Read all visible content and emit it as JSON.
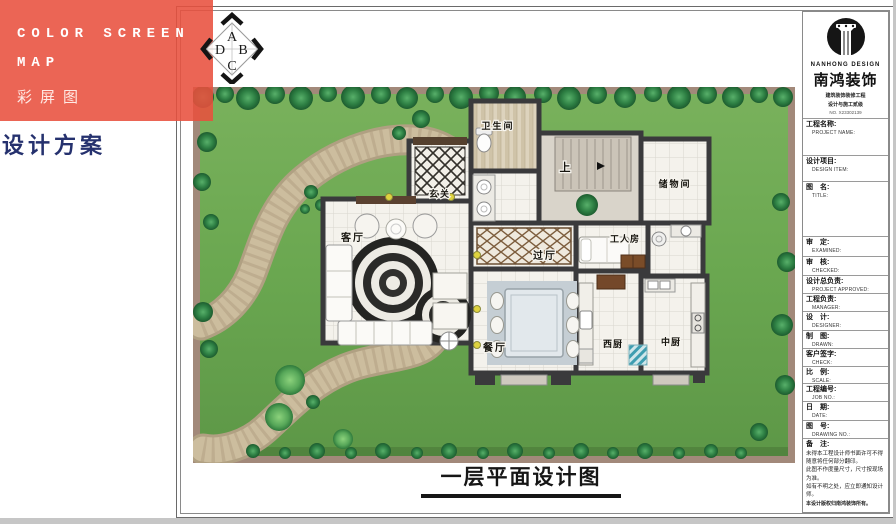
{
  "banner": {
    "title_line1": "COLOR SCREEN",
    "title_line2": "MAP",
    "title_line3": "彩屏图",
    "background_color": "#E8503E"
  },
  "page": {
    "scheme_label": "设计方案",
    "drawing_title": "一层平面设计图"
  },
  "compass": {
    "top": "A",
    "right": "B",
    "bottom": "C",
    "left": "D"
  },
  "plan": {
    "colors": {
      "lawn": "#6BA750",
      "lawn_border": "#A2897A",
      "wall": "#3A3A3C",
      "path": "#CCBD9E"
    },
    "rooms": [
      {
        "id": "bathroom",
        "label": "卫生间"
      },
      {
        "id": "entry",
        "label": "玄关"
      },
      {
        "id": "stairs-up",
        "label": "上"
      },
      {
        "id": "storage",
        "label": "储物间"
      },
      {
        "id": "living-room",
        "label": "客厅"
      },
      {
        "id": "hallway",
        "label": "过厅"
      },
      {
        "id": "worker-room",
        "label": "工人房"
      },
      {
        "id": "dining-room",
        "label": "餐厅"
      },
      {
        "id": "west-kitchen",
        "label": "西厨"
      },
      {
        "id": "chinese-kitchen",
        "label": "中厨"
      }
    ]
  },
  "titleblock": {
    "logo": {
      "name_en": "NANHONG DESIGN",
      "name_zh": "南鸿装饰",
      "sub1": "建筑装饰装修工程",
      "sub2": "设计与施工贰级",
      "license": "NO. X23302139"
    },
    "fields": [
      {
        "zh": "工程名称:",
        "en": "PROJECT NAME:"
      },
      {
        "zh": "设计项目:",
        "en": "DESIGN ITEM:"
      },
      {
        "zh": "图　名:",
        "en": "TITLE:"
      },
      {
        "zh": "审　定:",
        "en": "EXAMINED:"
      },
      {
        "zh": "审　核:",
        "en": "CHECKED:"
      },
      {
        "zh": "设计总负责:",
        "en": "PROJECT APPROVED:"
      },
      {
        "zh": "工程负责:",
        "en": "MANAGER:"
      },
      {
        "zh": "设　计:",
        "en": "DESIGNER:"
      },
      {
        "zh": "制　图:",
        "en": "DRAWN:"
      },
      {
        "zh": "客户签字:",
        "en": "CHECK:"
      },
      {
        "zh": "比　例:",
        "en": "SCALE:"
      },
      {
        "zh": "工程编号:",
        "en": "JOB NO.:"
      },
      {
        "zh": "日　期:",
        "en": "DATE:"
      },
      {
        "zh": "图　号:",
        "en": "DRAWING NO.:"
      }
    ],
    "notes": {
      "label": "备　注:",
      "line1": "未得本工程设计师书面许可不得随意将任何部分翻印。",
      "line2": "此图不作度量尺寸，尺寸按现场为准。",
      "line3": "如有不明之处，应立即通知设计师。",
      "line4": "本设计版权归南鸿装饰所有。",
      "phone": "免费咨询电话:400 6363 168"
    }
  }
}
